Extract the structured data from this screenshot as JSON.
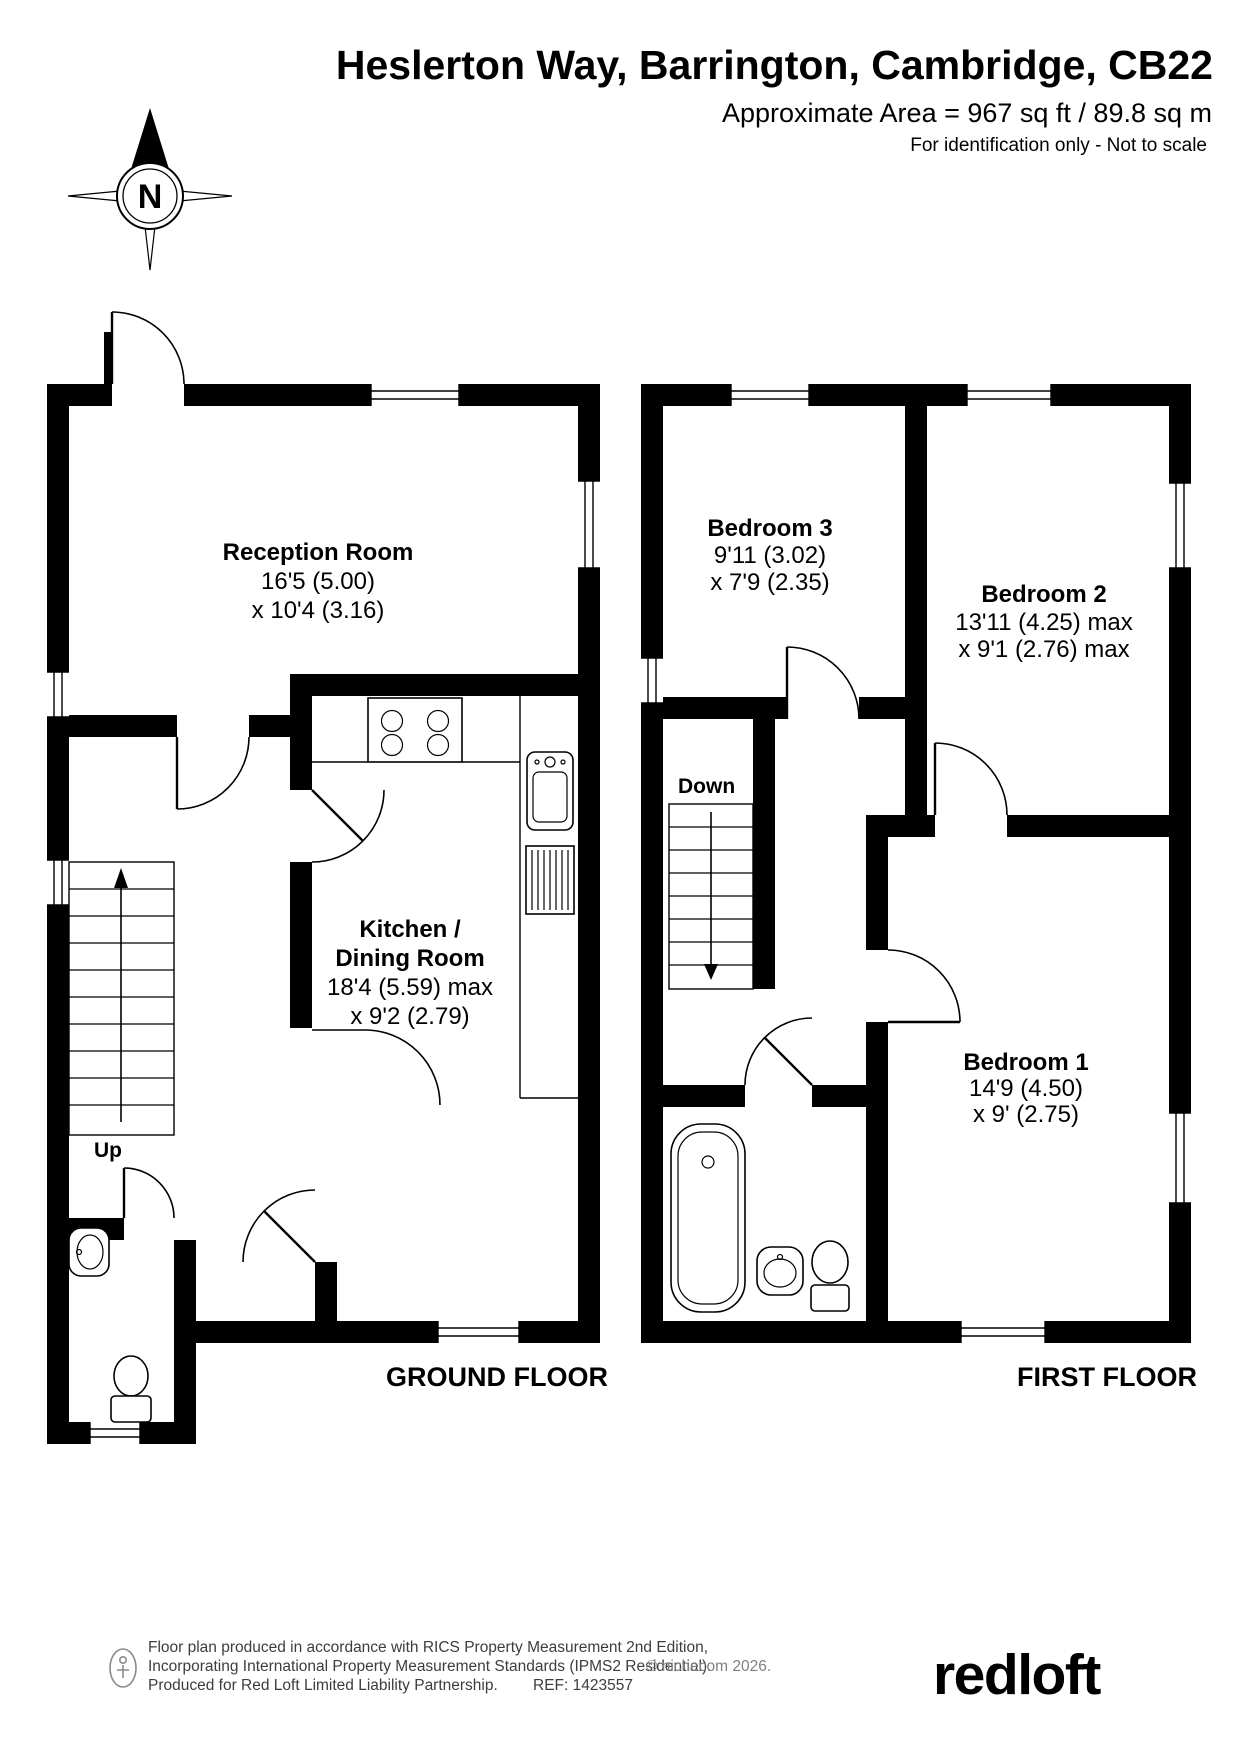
{
  "header": {
    "title": "Heslerton Way, Barrington, Cambridge, CB22",
    "area": "Approximate Area = 967 sq ft / 89.8 sq m",
    "disclaimer": "For identification only - Not to scale"
  },
  "compass": {
    "north": "N"
  },
  "ground_floor": {
    "label": "GROUND FLOOR",
    "stairs_label": "Up",
    "rooms": {
      "reception": {
        "name": "Reception Room",
        "dim1": "16'5 (5.00)",
        "dim2": "x 10'4 (3.16)"
      },
      "kitchen": {
        "name1": "Kitchen /",
        "name2": "Dining Room",
        "dim1": "18'4 (5.59) max",
        "dim2": "x 9'2 (2.79)"
      }
    }
  },
  "first_floor": {
    "label": "FIRST FLOOR",
    "stairs_label": "Down",
    "rooms": {
      "bedroom3": {
        "name": "Bedroom 3",
        "dim1": "9'11 (3.02)",
        "dim2": "x 7'9 (2.35)"
      },
      "bedroom2": {
        "name": "Bedroom 2",
        "dim1": "13'11 (4.25) max",
        "dim2": "x 9'1 (2.76) max"
      },
      "bedroom1": {
        "name": "Bedroom 1",
        "dim1": "14'9 (4.50)",
        "dim2": "x 9' (2.75)"
      }
    }
  },
  "footer": {
    "line1": "Floor plan produced in accordance with RICS Property Measurement 2nd Edition,",
    "line2": "Incorporating International Property Measurement Standards (IPMS2 Residential).",
    "copyright": "© nichecom 2026.",
    "line3": "Produced for Red Loft Limited Liability Partnership.",
    "ref": "REF: 1423557",
    "logo": "redloft"
  },
  "colors": {
    "wall": "#000000",
    "logo_red": "#e2231a",
    "footer_gray": "#3d3d3d"
  }
}
